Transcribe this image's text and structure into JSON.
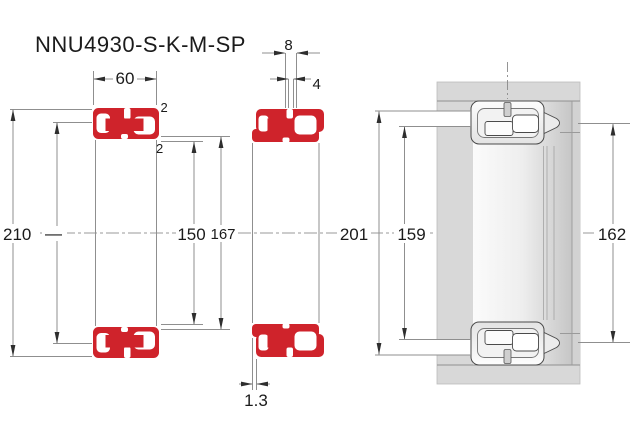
{
  "title": "NNU4930-S-K-M-SP",
  "figure_type": "double-row cylindrical roller bearing dimensional drawing",
  "dimensions": {
    "width": "60",
    "lube_groove_width": "8",
    "lube_hole_diameter": "4",
    "recess_top": "2",
    "recess_bottom": "2",
    "outer_diameter": "210",
    "outer_raceway_unspecified": "—",
    "bore_diameter": "150",
    "inner_raceway_diameter": "167",
    "outer_ring_raceway_diameter": "201",
    "shaft_shoulder_diameter": "159",
    "abutment_diameter": "162",
    "face_offset": "1.3"
  },
  "colors": {
    "bearing_red": "#cf232b",
    "dimension_line_gray": "#8f8f8f",
    "text_color": "#1b1b1b",
    "mount_block_gray": "#d8d8d8"
  }
}
